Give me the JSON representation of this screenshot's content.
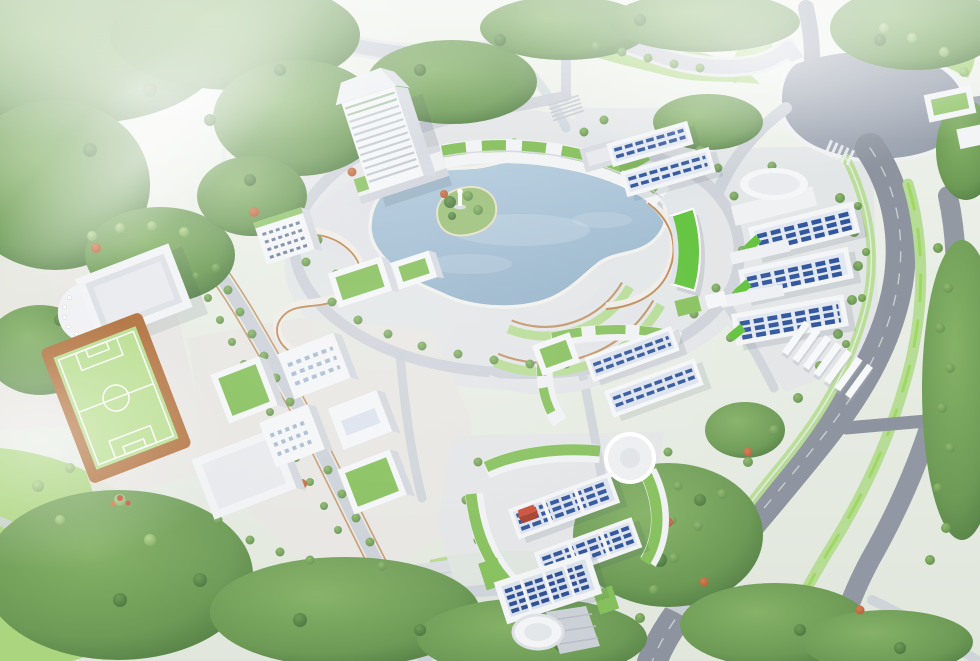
{
  "scene": {
    "type": "aerial-3d-architectural-rendering",
    "subject": "green university campus master plan with central lake",
    "view": "bird's-eye oblique",
    "atmosphere": "bright hazy daylight from upper left"
  },
  "palette": {
    "groundTop": "#eef2eb",
    "groundBottom": "#e1e7dd",
    "lawn": "#abd57e",
    "lawnPale": "#c6e5a0",
    "turf": "#b7dd8d",
    "track": "#b06f3a",
    "forest": "#6d9b56",
    "forestDark": "#4b7440",
    "treeLight": "#8fb96d",
    "accentRed": "#b65a3b",
    "waterLight": "#b6cedf",
    "waterDeep": "#97b4cb",
    "pavement": "#e2e4e7",
    "plazaWarm": "#e7e6e2",
    "roadLight": "#ccd1d8",
    "asphalt": "#8d949f",
    "plazaAsphalt": "#9aa2af",
    "median": "#b7dc95",
    "medianLime": "#9fd861",
    "wood": "#b5793f",
    "white": "#f5f6f8",
    "facadeShade": "#d6dae0",
    "glass": "#dce3ee",
    "windowBlue": "#2f549c",
    "roofGreen": "#86c05c",
    "limeRoof": "#5fc23a",
    "redRoof": "#c8503a",
    "mist": "#ffffff"
  },
  "elements": {
    "landmarks": [
      {
        "name": "main-tower",
        "desc": "white high-rise with pitched roof and banded floors"
      },
      {
        "name": "tower-annex-arc",
        "desc": "curved low wing with green roof patches along lake"
      },
      {
        "name": "central-lake",
        "desc": "organic lake with wooden boardwalk edges"
      },
      {
        "name": "lake-island",
        "desc": "green island with white statue"
      },
      {
        "name": "ring-gardens",
        "desc": "concentric hedge and path arcs south-east of lake"
      },
      {
        "name": "theater-building",
        "desc": "auditorium with rounded colonnade portico"
      },
      {
        "name": "soccer-field",
        "desc": "green pitch with clay-colored surround"
      },
      {
        "name": "workshop-cluster",
        "desc": "white cubes with green roofs and blue skylight grids"
      },
      {
        "name": "north-classroom-cluster",
        "desc": "glazed slabs with green podium roofs"
      },
      {
        "name": "south-classroom-cluster",
        "desc": "twin glazed slabs wrapped by green roof arcs"
      },
      {
        "name": "south-dormitory-slab",
        "desc": "blue glazed slab flanked by green roofs"
      },
      {
        "name": "east-dormitory-cluster",
        "desc": "three stepped slabs with blue window bands"
      },
      {
        "name": "oval-hall",
        "desc": "elliptical white roof hall"
      },
      {
        "name": "lime-curved-building",
        "desc": "crescent block with bright green roof"
      },
      {
        "name": "northeast-cluster",
        "desc": "glazed slabs with green ramp near entry"
      },
      {
        "name": "entry-plaza",
        "desc": "rounded asphalt gateway plaza"
      },
      {
        "name": "bus-canopies",
        "count": 7
      },
      {
        "name": "circular-court",
        "desc": "white ring plaza"
      },
      {
        "name": "round-pond",
        "desc": "white circular basin in south lawn"
      },
      {
        "name": "playground",
        "desc": "small red play equipment"
      }
    ],
    "roads": [
      "north-boundary-road",
      "main-avenue",
      "service-road",
      "campus-ring-road",
      "west-avenue",
      "south-plaza-road"
    ],
    "vegetation": [
      "boundary-forest",
      "meadow-lawns",
      "street-tree-rows",
      "red-flowering-accents"
    ]
  }
}
